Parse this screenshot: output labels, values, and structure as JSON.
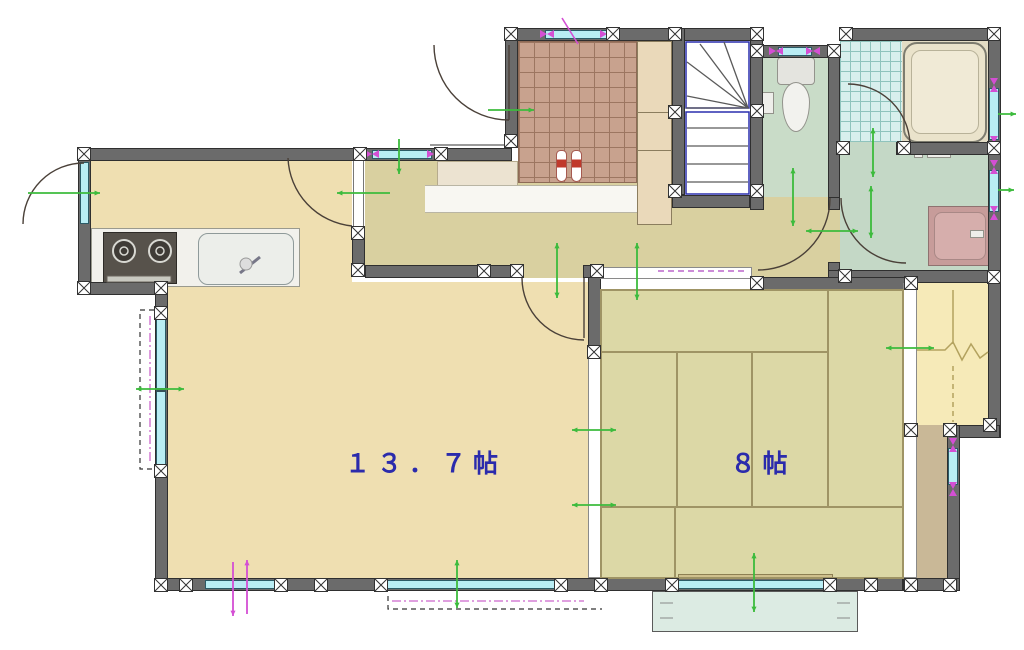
{
  "plan": {
    "type": "japanese-floor-plan",
    "labels": {
      "ldk": "１３．７帖",
      "tatami": "８帖"
    },
    "colors": {
      "wall": "#6b6b6b",
      "floor_wood": "#efdfb1",
      "floor_hall": "#d9d0a0",
      "tatami": "#dcd8a6",
      "genkan_tile": "#c8a28e",
      "bath_tile": "#d8efed",
      "sanitary_floor": "#c6d9c7",
      "closet": "#f6eab8",
      "corridor": "#c9b897",
      "veranda": "#dcebe3",
      "window_glass": "#b9edf4",
      "stairs_outline": "#2a2fae",
      "arrow_green": "#3dbb3d",
      "arrow_magenta": "#d44fd4",
      "label_blue": "#2b2bac"
    }
  }
}
